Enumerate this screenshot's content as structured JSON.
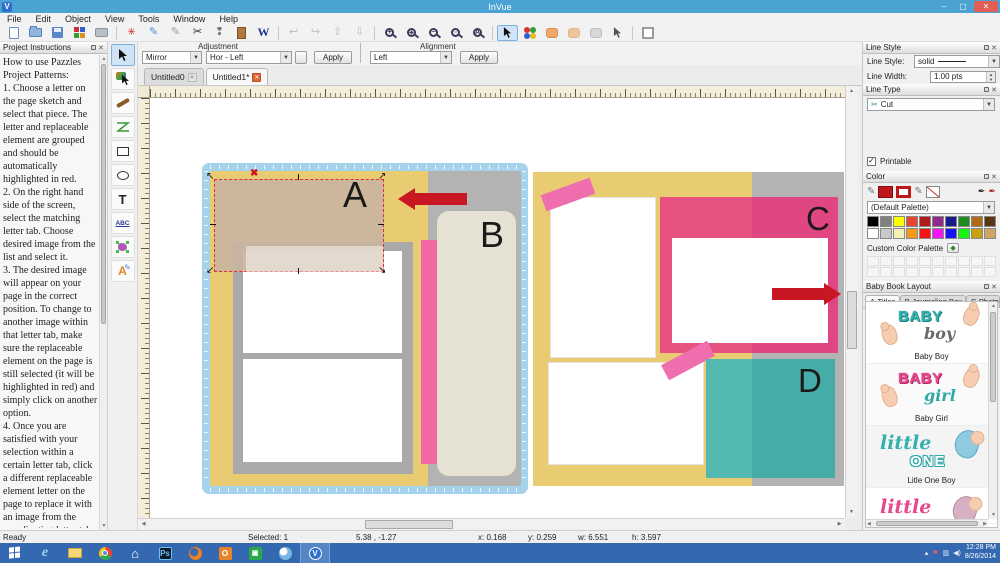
{
  "window": {
    "title": "InVue",
    "minimize": "–",
    "restore": "▢",
    "close": "✕"
  },
  "menu": {
    "items": [
      "File",
      "Edit",
      "Object",
      "View",
      "Tools",
      "Window",
      "Help"
    ]
  },
  "adjustment": {
    "label": "Adjustment",
    "mirror_value": "Mirror",
    "mode_value": "Hor - Left",
    "apply_label": "Apply"
  },
  "alignment": {
    "label": "Alignment",
    "value": "Left",
    "apply_label": "Apply"
  },
  "doc_tabs": [
    {
      "label": "Untitled0"
    },
    {
      "label": "Untitled1*"
    }
  ],
  "project_instructions": {
    "title": "Project Instructions",
    "text": "How to use Pazzles Project Patterns:\n1. Choose a letter on the page sketch and select that piece. The letter and replaceable element are grouped and should be automatically highlighted in red.\n2. On the right hand side of the screen, select the matching letter tab. Choose desired image from the list and select it.\n3. The desired image will appear on your page in the correct position. To change to another image within that letter tab, make sure the replaceable element on the page is still selected (it will be highlighted in red) and simply click on another option.\n4. Once you are satisfied with your selection within a certain letter tab, click a different replaceable element letter on the page to replace it with an image from the coordinating letter tab.\n5.For this layout the journaling boxes require the use of a Pazzles Pen Tool. You may also print these out on your home printer instead of using the Pen Tool, but the journaling lines are nort suitable for cutting.\n6. Once the page is designed, you may add or delete images or photo boxes before cutting.\n7. To place one of the"
  },
  "canvas": {
    "labels": {
      "a": "A",
      "b": "B",
      "c": "C",
      "d": "D"
    }
  },
  "right_panel": {
    "line_style": {
      "title": "Line Style",
      "style_label": "Line Style:",
      "style_value": "solid",
      "width_label": "Line Width:",
      "width_value": "1.00 pts"
    },
    "line_type": {
      "title": "Line Type",
      "value": "Cut"
    },
    "printable_label": "Printable",
    "color": {
      "title": "Color",
      "palette_value": "(Default Palette)",
      "custom_label": "Custom Color Palette",
      "swatches_row1": [
        "#000000",
        "#808080",
        "#ffff00",
        "#e8452c",
        "#b01c1c",
        "#8e2a8e",
        "#1a1a8c",
        "#1e8c1e",
        "#b06a1a",
        "#5a3610"
      ],
      "swatches_row2": [
        "#ffffff",
        "#c8c8c8",
        "#f5f0b4",
        "#f59a1a",
        "#f51414",
        "#f514f5",
        "#1414f5",
        "#14f514",
        "#c8a014",
        "#d2a464"
      ]
    },
    "library": {
      "title": "Baby Book Layout",
      "tabs": [
        "A-Titles",
        "B-Journaling Box",
        "C-Photo f"
      ],
      "items": [
        {
          "label": "Baby Boy",
          "word1": "BABY",
          "word2": "boy"
        },
        {
          "label": "Baby Girl",
          "word1": "BABY",
          "word2": "girl"
        },
        {
          "label": "Litle One Boy",
          "word1": "little",
          "word2": "ONE"
        },
        {
          "label": "",
          "word1": "little",
          "word2": ""
        }
      ]
    }
  },
  "status_bar": {
    "ready": "Ready",
    "selected": "Selected: 1",
    "cursor": "5.38 , -1.27",
    "x": "x: 0.168",
    "y": "y: 0.259",
    "w": "w: 6.551",
    "h": "h: 3.597"
  },
  "taskbar": {
    "clock_time": "12:28 PM",
    "clock_date": "8/26/2014"
  },
  "colors": {
    "titlebar": "#4ba3d4",
    "taskbar": "#3468b0",
    "arrow_red": "#c81722",
    "mat_blue": "#a6d3ec",
    "page_yellow": "#e9cb72",
    "ribbon_pink": "#f268a2",
    "frame_pink": "#e6527d",
    "teal": "#53b8b0",
    "journal_cream": "#e5e2d3",
    "selection_tan": "#c9b49f"
  }
}
